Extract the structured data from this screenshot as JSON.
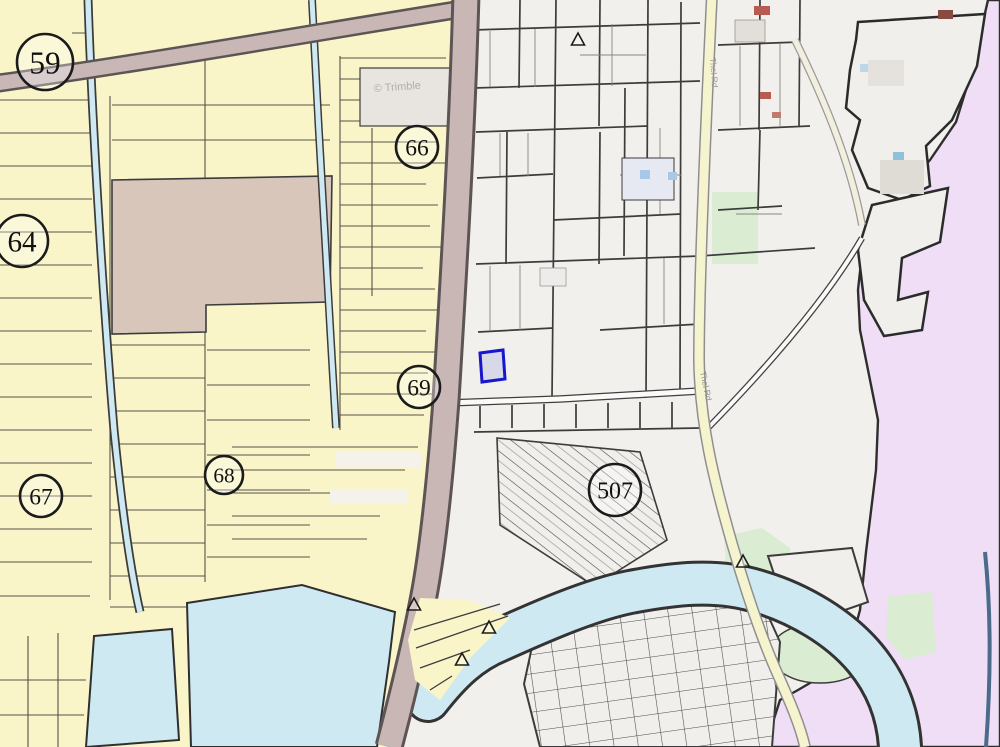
{
  "map": {
    "type": "cadastral-parcel-map-viewer",
    "watermark": "© Trimble",
    "colors": {
      "farmland_parcel_yellow": "#f9f5c9",
      "urban_parcel_gray": "#f2f0ec",
      "outside_boundary_pink": "#f0def6",
      "water_blue": "#cfe9f3",
      "greenery": "#daecd2",
      "major_road_brown": "#c9b7b6",
      "minor_road_yellow": "#f6f3cf",
      "parcel_outline_dark": "#3c3c3c",
      "large_parcel_tan": "#d7c6b9",
      "highlight_parcel_border": "#1616cc",
      "highlight_parcel_fill": "#d7d9e9"
    },
    "survey_markers": [
      {
        "label": "59",
        "x": 45,
        "y": 62,
        "r": 28
      },
      {
        "label": "64",
        "x": 22,
        "y": 241,
        "r": 26
      },
      {
        "label": "66",
        "x": 417,
        "y": 147,
        "r": 21
      },
      {
        "label": "67",
        "x": 41,
        "y": 496,
        "r": 21
      },
      {
        "label": "68",
        "x": 224,
        "y": 475,
        "r": 19
      },
      {
        "label": "69",
        "x": 419,
        "y": 387,
        "r": 21
      },
      {
        "label": "507",
        "x": 615,
        "y": 490,
        "r": 26
      }
    ],
    "triangle_markers": [
      {
        "x": 578,
        "y": 40
      },
      {
        "x": 414,
        "y": 605
      },
      {
        "x": 489,
        "y": 628
      },
      {
        "x": 462,
        "y": 660
      },
      {
        "x": 743,
        "y": 562
      }
    ],
    "highlighted_parcel": {
      "points": "480,353 503,350 505,379 482,382"
    },
    "road_labels": [
      {
        "text": "Thel Rd",
        "x": 700,
        "y": 372,
        "rotate": 78
      },
      {
        "text": "Thel Rd",
        "x": 710,
        "y": 58,
        "rotate": 86
      }
    ]
  }
}
